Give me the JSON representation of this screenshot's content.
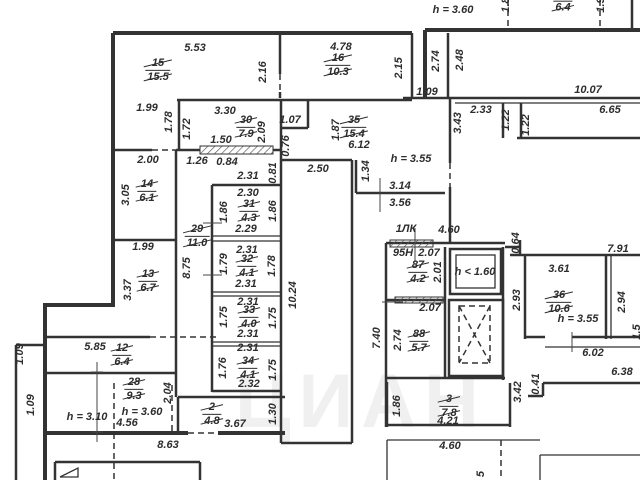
{
  "watermark": "ЦИАН",
  "colors": {
    "wall": "#333333",
    "label": "#2d2d2d",
    "background": "#ffffff"
  },
  "labels": [
    {
      "text": "5.53",
      "x": 195,
      "y": 48
    },
    {
      "text": "4.78",
      "x": 341,
      "y": 47
    },
    {
      "text": "h = 3.60",
      "x": 453,
      "y": 10,
      "kind": "ceiling-height-label"
    },
    {
      "text": "1.8",
      "x": 506,
      "y": 5,
      "v": true
    },
    {
      "text": "1.9",
      "x": 601,
      "y": 5,
      "v": true
    },
    {
      "text": "2.16",
      "x": 263,
      "y": 72,
      "v": true
    },
    {
      "text": "2.15",
      "x": 399,
      "y": 68,
      "v": true
    },
    {
      "text": "2.74",
      "x": 436,
      "y": 61,
      "v": true
    },
    {
      "text": "2.48",
      "x": 460,
      "y": 60,
      "v": true
    },
    {
      "text": "1.99",
      "x": 147,
      "y": 108
    },
    {
      "text": "3.30",
      "x": 225,
      "y": 111
    },
    {
      "text": "1.07",
      "x": 290,
      "y": 120
    },
    {
      "text": "1.78",
      "x": 169,
      "y": 122,
      "v": true
    },
    {
      "text": "1.72",
      "x": 187,
      "y": 129,
      "v": true
    },
    {
      "text": "2.09",
      "x": 262,
      "y": 132,
      "v": true
    },
    {
      "text": "0.76",
      "x": 286,
      "y": 146,
      "v": true
    },
    {
      "text": "1.50",
      "x": 221,
      "y": 140
    },
    {
      "text": "2.00",
      "x": 148,
      "y": 160
    },
    {
      "text": "1.26",
      "x": 197,
      "y": 161
    },
    {
      "text": "0.84",
      "x": 227,
      "y": 162
    },
    {
      "text": "1.87",
      "x": 336,
      "y": 130,
      "v": true
    },
    {
      "text": "6.12",
      "x": 359,
      "y": 145
    },
    {
      "text": "h = 3.55",
      "x": 411,
      "y": 159,
      "kind": "ceiling-height-label"
    },
    {
      "text": "1.09",
      "x": 427,
      "y": 92
    },
    {
      "text": "10.07",
      "x": 588,
      "y": 90
    },
    {
      "text": "2.33",
      "x": 481,
      "y": 110
    },
    {
      "text": "6.65",
      "x": 610,
      "y": 110
    },
    {
      "text": "3.43",
      "x": 458,
      "y": 123,
      "v": true
    },
    {
      "text": "1.22",
      "x": 506,
      "y": 120,
      "v": true
    },
    {
      "text": "1.22",
      "x": 526,
      "y": 125,
      "v": true
    },
    {
      "text": "2.31",
      "x": 248,
      "y": 176
    },
    {
      "text": "0.81",
      "x": 273,
      "y": 173,
      "v": true
    },
    {
      "text": "2.50",
      "x": 318,
      "y": 169
    },
    {
      "text": "1.34",
      "x": 366,
      "y": 171,
      "v": true
    },
    {
      "text": "3.14",
      "x": 400,
      "y": 186
    },
    {
      "text": "3.56",
      "x": 400,
      "y": 203
    },
    {
      "text": "3.05",
      "x": 126,
      "y": 195,
      "v": true
    },
    {
      "text": "2.30",
      "x": 248,
      "y": 193
    },
    {
      "text": "1.86",
      "x": 224,
      "y": 212,
      "v": true
    },
    {
      "text": "1.86",
      "x": 273,
      "y": 211,
      "v": true
    },
    {
      "text": "2.29",
      "x": 246,
      "y": 229
    },
    {
      "text": "1.99",
      "x": 143,
      "y": 247
    },
    {
      "text": "2.31",
      "x": 247,
      "y": 250
    },
    {
      "text": "1.79",
      "x": 224,
      "y": 264,
      "v": true
    },
    {
      "text": "1.78",
      "x": 272,
      "y": 266,
      "v": true
    },
    {
      "text": "2.31",
      "x": 246,
      "y": 284
    },
    {
      "text": "8.75",
      "x": 187,
      "y": 268,
      "v": true
    },
    {
      "text": "3.37",
      "x": 128,
      "y": 290,
      "v": true
    },
    {
      "text": "2.31",
      "x": 248,
      "y": 302
    },
    {
      "text": "1.75",
      "x": 224,
      "y": 317,
      "v": true
    },
    {
      "text": "1.75",
      "x": 273,
      "y": 318,
      "v": true
    },
    {
      "text": "10.24",
      "x": 293,
      "y": 295,
      "v": true
    },
    {
      "text": "2.31",
      "x": 248,
      "y": 334
    },
    {
      "text": "2.31",
      "x": 248,
      "y": 348
    },
    {
      "text": "1.76",
      "x": 223,
      "y": 368,
      "v": true
    },
    {
      "text": "1.75",
      "x": 273,
      "y": 370,
      "v": true
    },
    {
      "text": "2.32",
      "x": 249,
      "y": 384
    },
    {
      "text": "1ЛК",
      "x": 406,
      "y": 229,
      "kind": "stairwell-label"
    },
    {
      "text": "4.60",
      "x": 449,
      "y": 230
    },
    {
      "text": "0.64",
      "x": 516,
      "y": 243,
      "v": true
    },
    {
      "text": "95Н",
      "x": 403,
      "y": 253,
      "kind": "unit-number-label"
    },
    {
      "text": "2.07",
      "x": 429,
      "y": 253
    },
    {
      "text": "2.01",
      "x": 438,
      "y": 272,
      "v": true
    },
    {
      "text": "h < 1.60",
      "x": 475,
      "y": 272,
      "kind": "ceiling-height-label"
    },
    {
      "text": "2.07",
      "x": 430,
      "y": 308
    },
    {
      "text": "2.74",
      "x": 398,
      "y": 340,
      "v": true
    },
    {
      "text": "7.40",
      "x": 377,
      "y": 338,
      "v": true
    },
    {
      "text": "7.91",
      "x": 618,
      "y": 249
    },
    {
      "text": "3.61",
      "x": 559,
      "y": 269
    },
    {
      "text": "2.93",
      "x": 517,
      "y": 300,
      "v": true
    },
    {
      "text": "2.94",
      "x": 622,
      "y": 302,
      "v": true
    },
    {
      "text": "1.5",
      "x": 637,
      "y": 332,
      "v": true
    },
    {
      "text": "h = 3.55",
      "x": 578,
      "y": 319,
      "kind": "ceiling-height-label"
    },
    {
      "text": "6.02",
      "x": 593,
      "y": 353
    },
    {
      "text": "6.38",
      "x": 622,
      "y": 372
    },
    {
      "text": "0.41",
      "x": 536,
      "y": 384,
      "v": true
    },
    {
      "text": "3.42",
      "x": 518,
      "y": 392,
      "v": true
    },
    {
      "text": "1.86",
      "x": 397,
      "y": 406,
      "v": true
    },
    {
      "text": "4.21",
      "x": 448,
      "y": 421
    },
    {
      "text": "4.60",
      "x": 450,
      "y": 446
    },
    {
      "text": "5",
      "x": 481,
      "y": 474,
      "v": true
    },
    {
      "text": "5.85",
      "x": 95,
      "y": 347
    },
    {
      "text": "1.09",
      "x": 20,
      "y": 354,
      "v": true
    },
    {
      "text": "1.09",
      "x": 31,
      "y": 405,
      "v": true
    },
    {
      "text": "2.04",
      "x": 168,
      "y": 393,
      "v": true
    },
    {
      "text": "h = 3.10",
      "x": 87,
      "y": 417,
      "kind": "ceiling-height-label"
    },
    {
      "text": "h = 3.60",
      "x": 142,
      "y": 412,
      "kind": "ceiling-height-label"
    },
    {
      "text": "4.56",
      "x": 127,
      "y": 423
    },
    {
      "text": "3.67",
      "x": 235,
      "y": 424
    },
    {
      "text": "1.30",
      "x": 273,
      "y": 414,
      "v": true
    },
    {
      "text": "8.63",
      "x": 168,
      "y": 445
    }
  ],
  "rooms": [
    {
      "number": "15",
      "area": "15.5",
      "x": 158,
      "y": 70
    },
    {
      "number": "16",
      "area": "10.3",
      "x": 338,
      "y": 65
    },
    {
      "number": "",
      "area": "6.4",
      "x": 563,
      "y": 5
    },
    {
      "number": "30",
      "area": "7.9",
      "x": 246,
      "y": 127
    },
    {
      "number": "35",
      "area": "15.4",
      "x": 354,
      "y": 127
    },
    {
      "number": "14",
      "area": "6.1",
      "x": 147,
      "y": 191
    },
    {
      "number": "31",
      "area": "4.3",
      "x": 249,
      "y": 211
    },
    {
      "number": "29",
      "area": "11.0",
      "x": 197,
      "y": 236
    },
    {
      "number": "32",
      "area": "4.1",
      "x": 247,
      "y": 266
    },
    {
      "number": "13",
      "area": "6.7",
      "x": 148,
      "y": 281
    },
    {
      "number": "33",
      "area": "4.0",
      "x": 249,
      "y": 317
    },
    {
      "number": "34",
      "area": "4.1",
      "x": 248,
      "y": 368
    },
    {
      "number": "12",
      "area": "6.4",
      "x": 122,
      "y": 355
    },
    {
      "number": "28",
      "area": "9.3",
      "x": 134,
      "y": 389
    },
    {
      "number": "2",
      "area": "4.8",
      "x": 212,
      "y": 414
    },
    {
      "number": "87",
      "area": "4.2",
      "x": 418,
      "y": 272
    },
    {
      "number": "88",
      "area": "5.7",
      "x": 419,
      "y": 341
    },
    {
      "number": "36",
      "area": "10.6",
      "x": 559,
      "y": 302
    },
    {
      "number": "3",
      "area": "7.8",
      "x": 449,
      "y": 406
    }
  ]
}
